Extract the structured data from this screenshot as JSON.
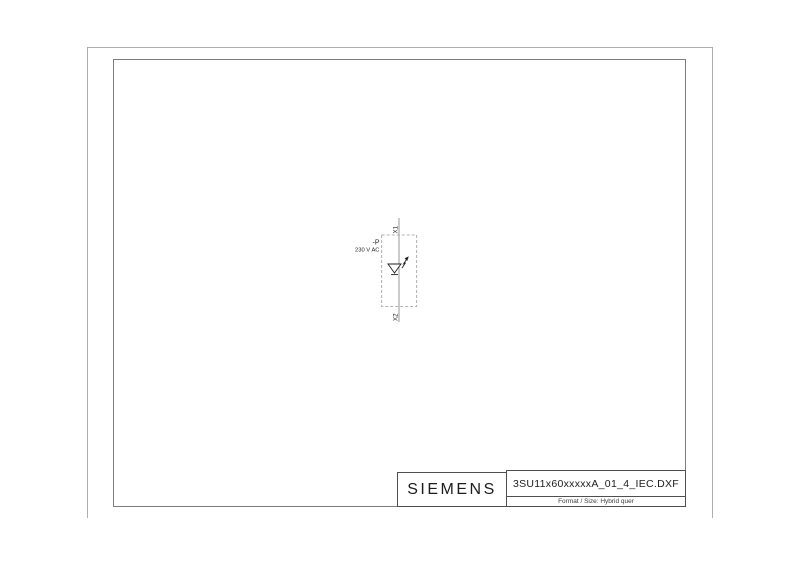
{
  "sheet": {
    "background_color": "#ffffff",
    "outer_frame_color": "#aeaeae",
    "inner_frame_color": "#7d7d7d"
  },
  "schematic": {
    "designation": "-P",
    "voltage": "230 V AC",
    "terminal_top": "X1",
    "terminal_bottom": "X2",
    "symbol_icon": "led-indicator-lamp-with-flash-icon",
    "wire_color": "#8c8c8c",
    "symbol_color": "#1f1f1f"
  },
  "title_block": {
    "brand": "SIEMENS",
    "filename": "3SU11x60xxxxxA_01_4_IEC.DXF",
    "format_info": "Format / Size: Hybrid quer"
  }
}
